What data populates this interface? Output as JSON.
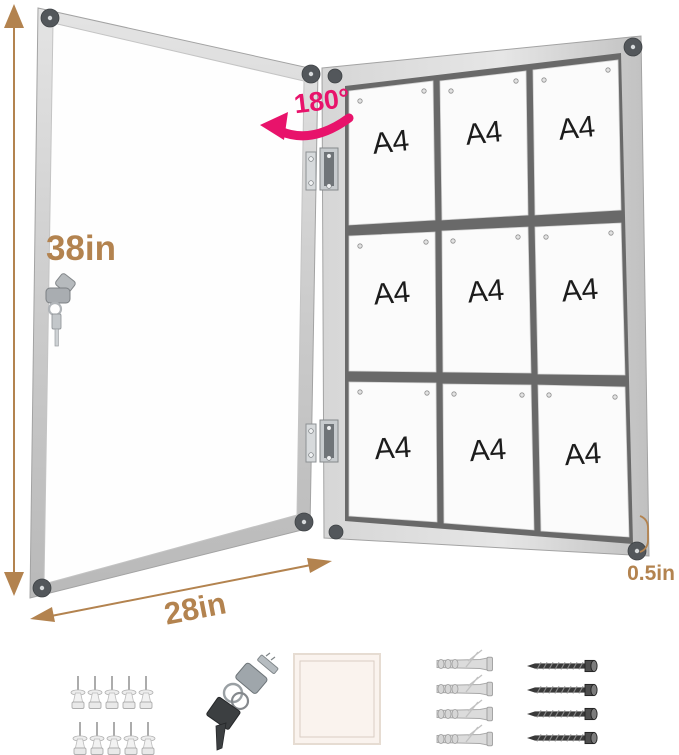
{
  "annotations": {
    "height": "38in",
    "width": "28in",
    "frame_depth": "0.5in",
    "door_opening_angle": "180°"
  },
  "board": {
    "sheets": [
      {
        "label": "A4"
      },
      {
        "label": "A4"
      },
      {
        "label": "A4"
      },
      {
        "label": "A4"
      },
      {
        "label": "A4"
      },
      {
        "label": "A4"
      },
      {
        "label": "A4"
      },
      {
        "label": "A4"
      },
      {
        "label": "A4"
      }
    ]
  },
  "accessories": {
    "push_pins": {
      "icon": "push-pin-icon",
      "count": 10
    },
    "keys": {
      "icon": "keys-icon",
      "count": 2
    },
    "adhesive_pad": {
      "icon": "adhesive-pad-icon",
      "count": 1
    },
    "wall_anchors": {
      "icon": "wall-anchor-icon",
      "count": 4
    },
    "screws": {
      "icon": "screw-icon",
      "count": 4
    }
  },
  "colors": {
    "dimension_label": "#b3834f",
    "rotation_label": "#e8136b",
    "frame_light": "#dedede",
    "frame_dark": "#c2c2c2",
    "corner_cap": "#53575b",
    "board_gap": "#696969",
    "sheet": "#fbfbfb"
  }
}
